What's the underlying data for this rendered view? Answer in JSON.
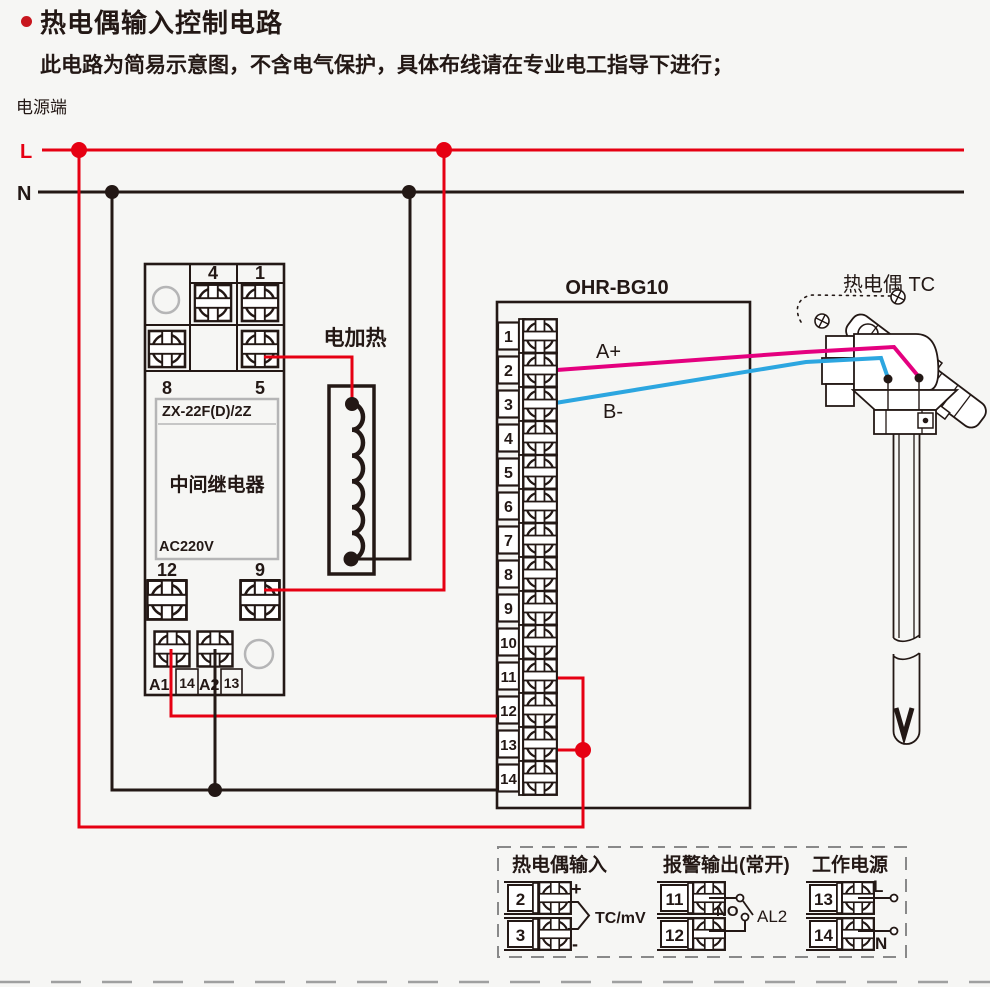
{
  "header": {
    "title": "热电偶输入控制电路",
    "subtitle": "此电路为简易示意图，不含电气保护，具体布线请在专业电工指导下进行；"
  },
  "power": {
    "section_label": "电源端",
    "live": "L",
    "neutral": "N"
  },
  "relay": {
    "model": "ZX-22F(D)/2Z",
    "name": "中间继电器",
    "voltage": "AC220V",
    "t4": "4",
    "t1": "1",
    "t8": "8",
    "t5": "5",
    "t12": "12",
    "t9": "9",
    "a1": "A1",
    "a2": "A2",
    "t14": "14",
    "t13": "13"
  },
  "heater": {
    "label": "电加热"
  },
  "controller": {
    "model": "OHR-BG10",
    "tc_pos": "A+",
    "tc_neg": "B-",
    "terminals": [
      "1",
      "2",
      "3",
      "4",
      "5",
      "6",
      "7",
      "8",
      "9",
      "10",
      "11",
      "12",
      "13",
      "14"
    ]
  },
  "thermocouple": {
    "label": "热电偶 TC"
  },
  "legend": {
    "tc": {
      "title": "热电偶输入",
      "top": "2",
      "bottom": "3",
      "plus": "+",
      "minus": "-",
      "signal": "TC/mV"
    },
    "alarm": {
      "title": "报警输出(常开)",
      "top": "11",
      "bottom": "12",
      "mode": "NO",
      "name": "AL2"
    },
    "supply": {
      "title": "工作电源",
      "top": "13",
      "bottom": "14",
      "live": "L",
      "neutral": "N"
    }
  },
  "colors": {
    "red": "#e60012",
    "dark": "#231815",
    "magenta": "#e4007f",
    "cyan": "#2ca6e0",
    "gray": "#9fa0a0",
    "bullet": "#c8161e",
    "lgray": "#b5b5b6"
  }
}
